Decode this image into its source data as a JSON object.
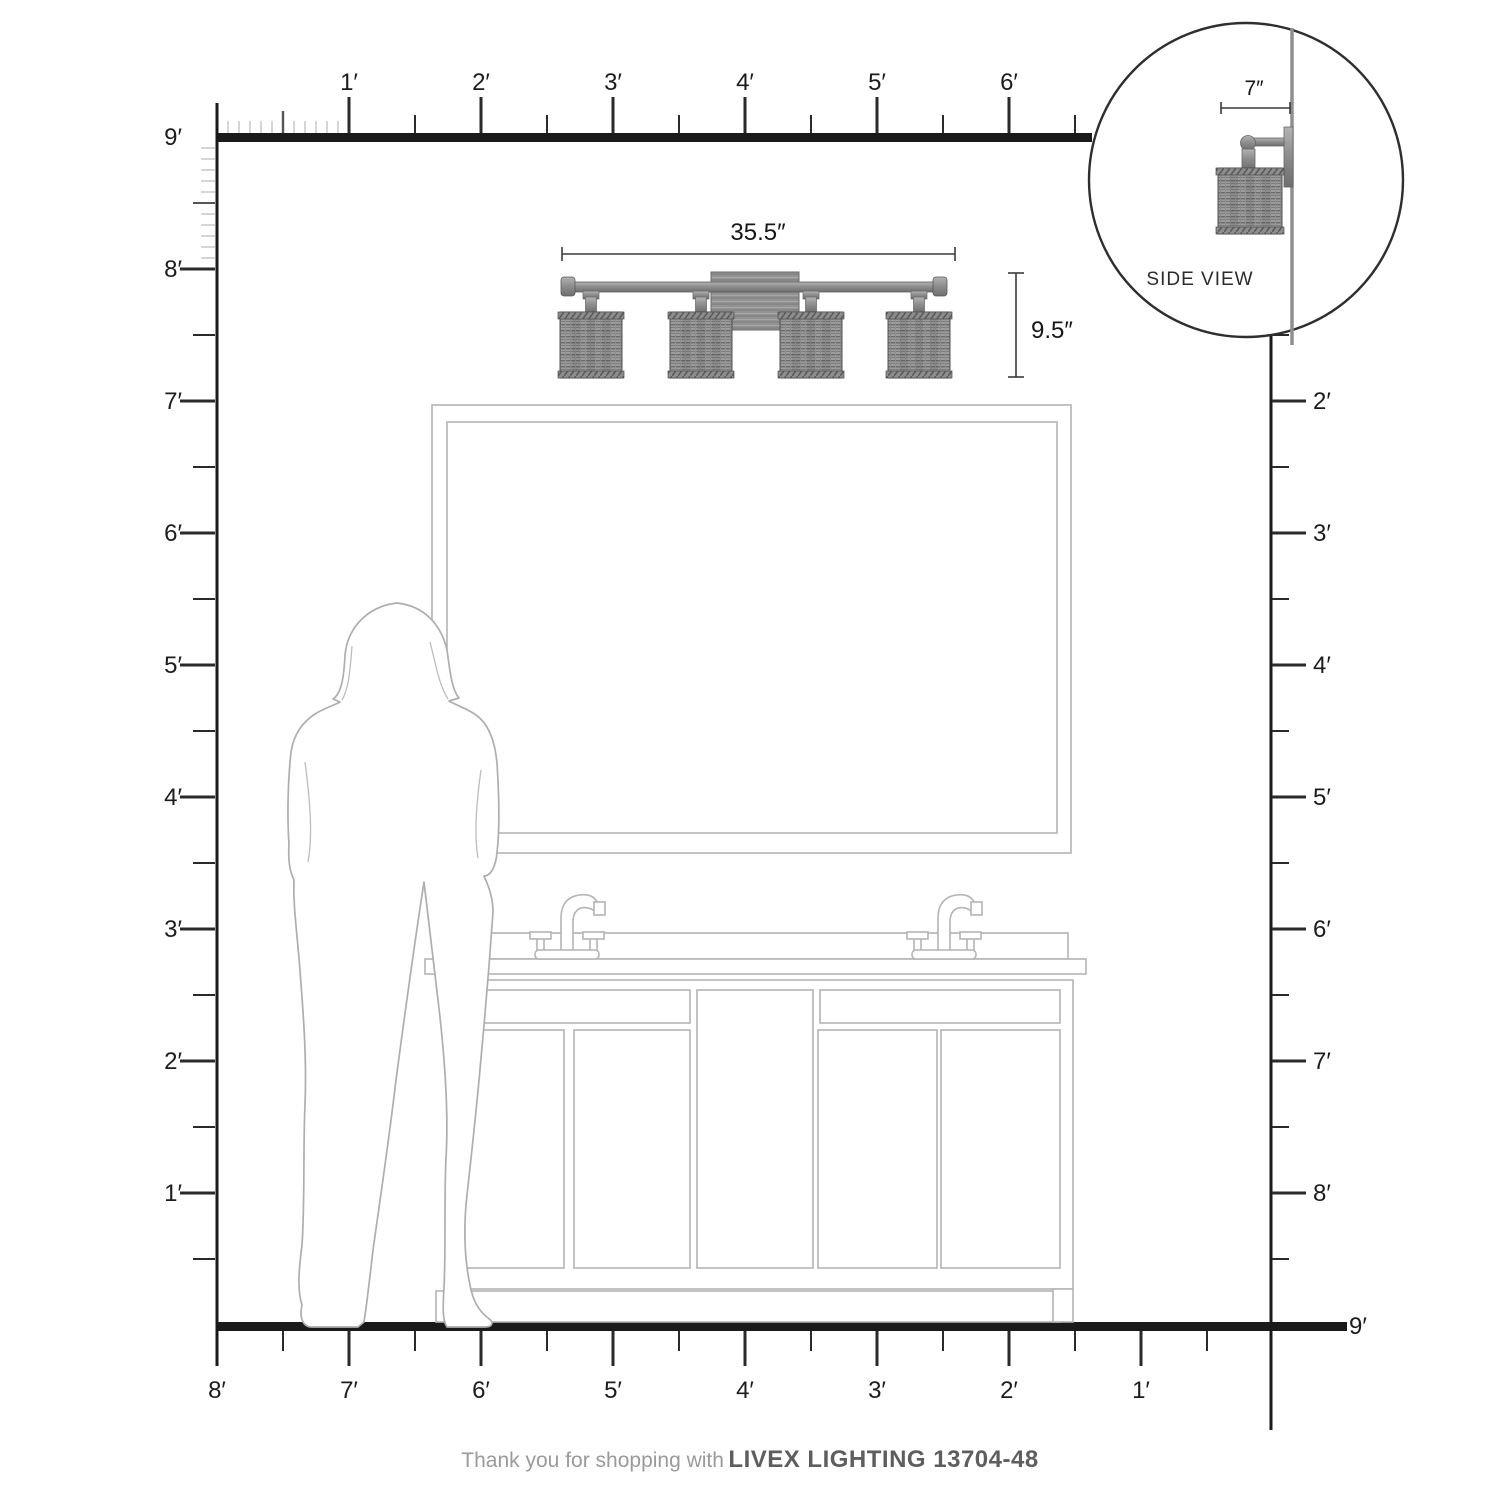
{
  "document": {
    "type": "product dimension diagram",
    "product": "vanity light fixture"
  },
  "rulers": {
    "top": [
      "1′",
      "2′",
      "3′",
      "4′",
      "5′",
      "6′"
    ],
    "left": [
      "9′",
      "8′",
      "7′",
      "6′",
      "5′",
      "4′",
      "3′",
      "2′",
      "1′"
    ],
    "right": [
      "2′",
      "3′",
      "4′",
      "5′",
      "6′",
      "7′",
      "8′"
    ],
    "right_floor": "9′",
    "bottom": [
      "8′",
      "7′",
      "6′",
      "5′",
      "4′",
      "3′",
      "2′",
      "1′"
    ]
  },
  "fixture": {
    "width_label": "35.5″",
    "height_label": "9.5″",
    "shade_count": 4
  },
  "side_view": {
    "depth_label": "7″",
    "caption": "SIDE VIEW"
  },
  "footer": {
    "prefix": "Thank you for shopping with",
    "brand": "LIVEX LIGHTING 13704-48"
  },
  "colors": {
    "ruler_line": "#1a1a1a",
    "tick_dark": "#2a2a2a",
    "tick_light": "#c8c8c8",
    "drawing_gray": "#b4b4b4",
    "fixture_metal": "#8f8f8f",
    "footer_text": "#9a9a9a",
    "footer_brand": "#5e5e5e"
  }
}
